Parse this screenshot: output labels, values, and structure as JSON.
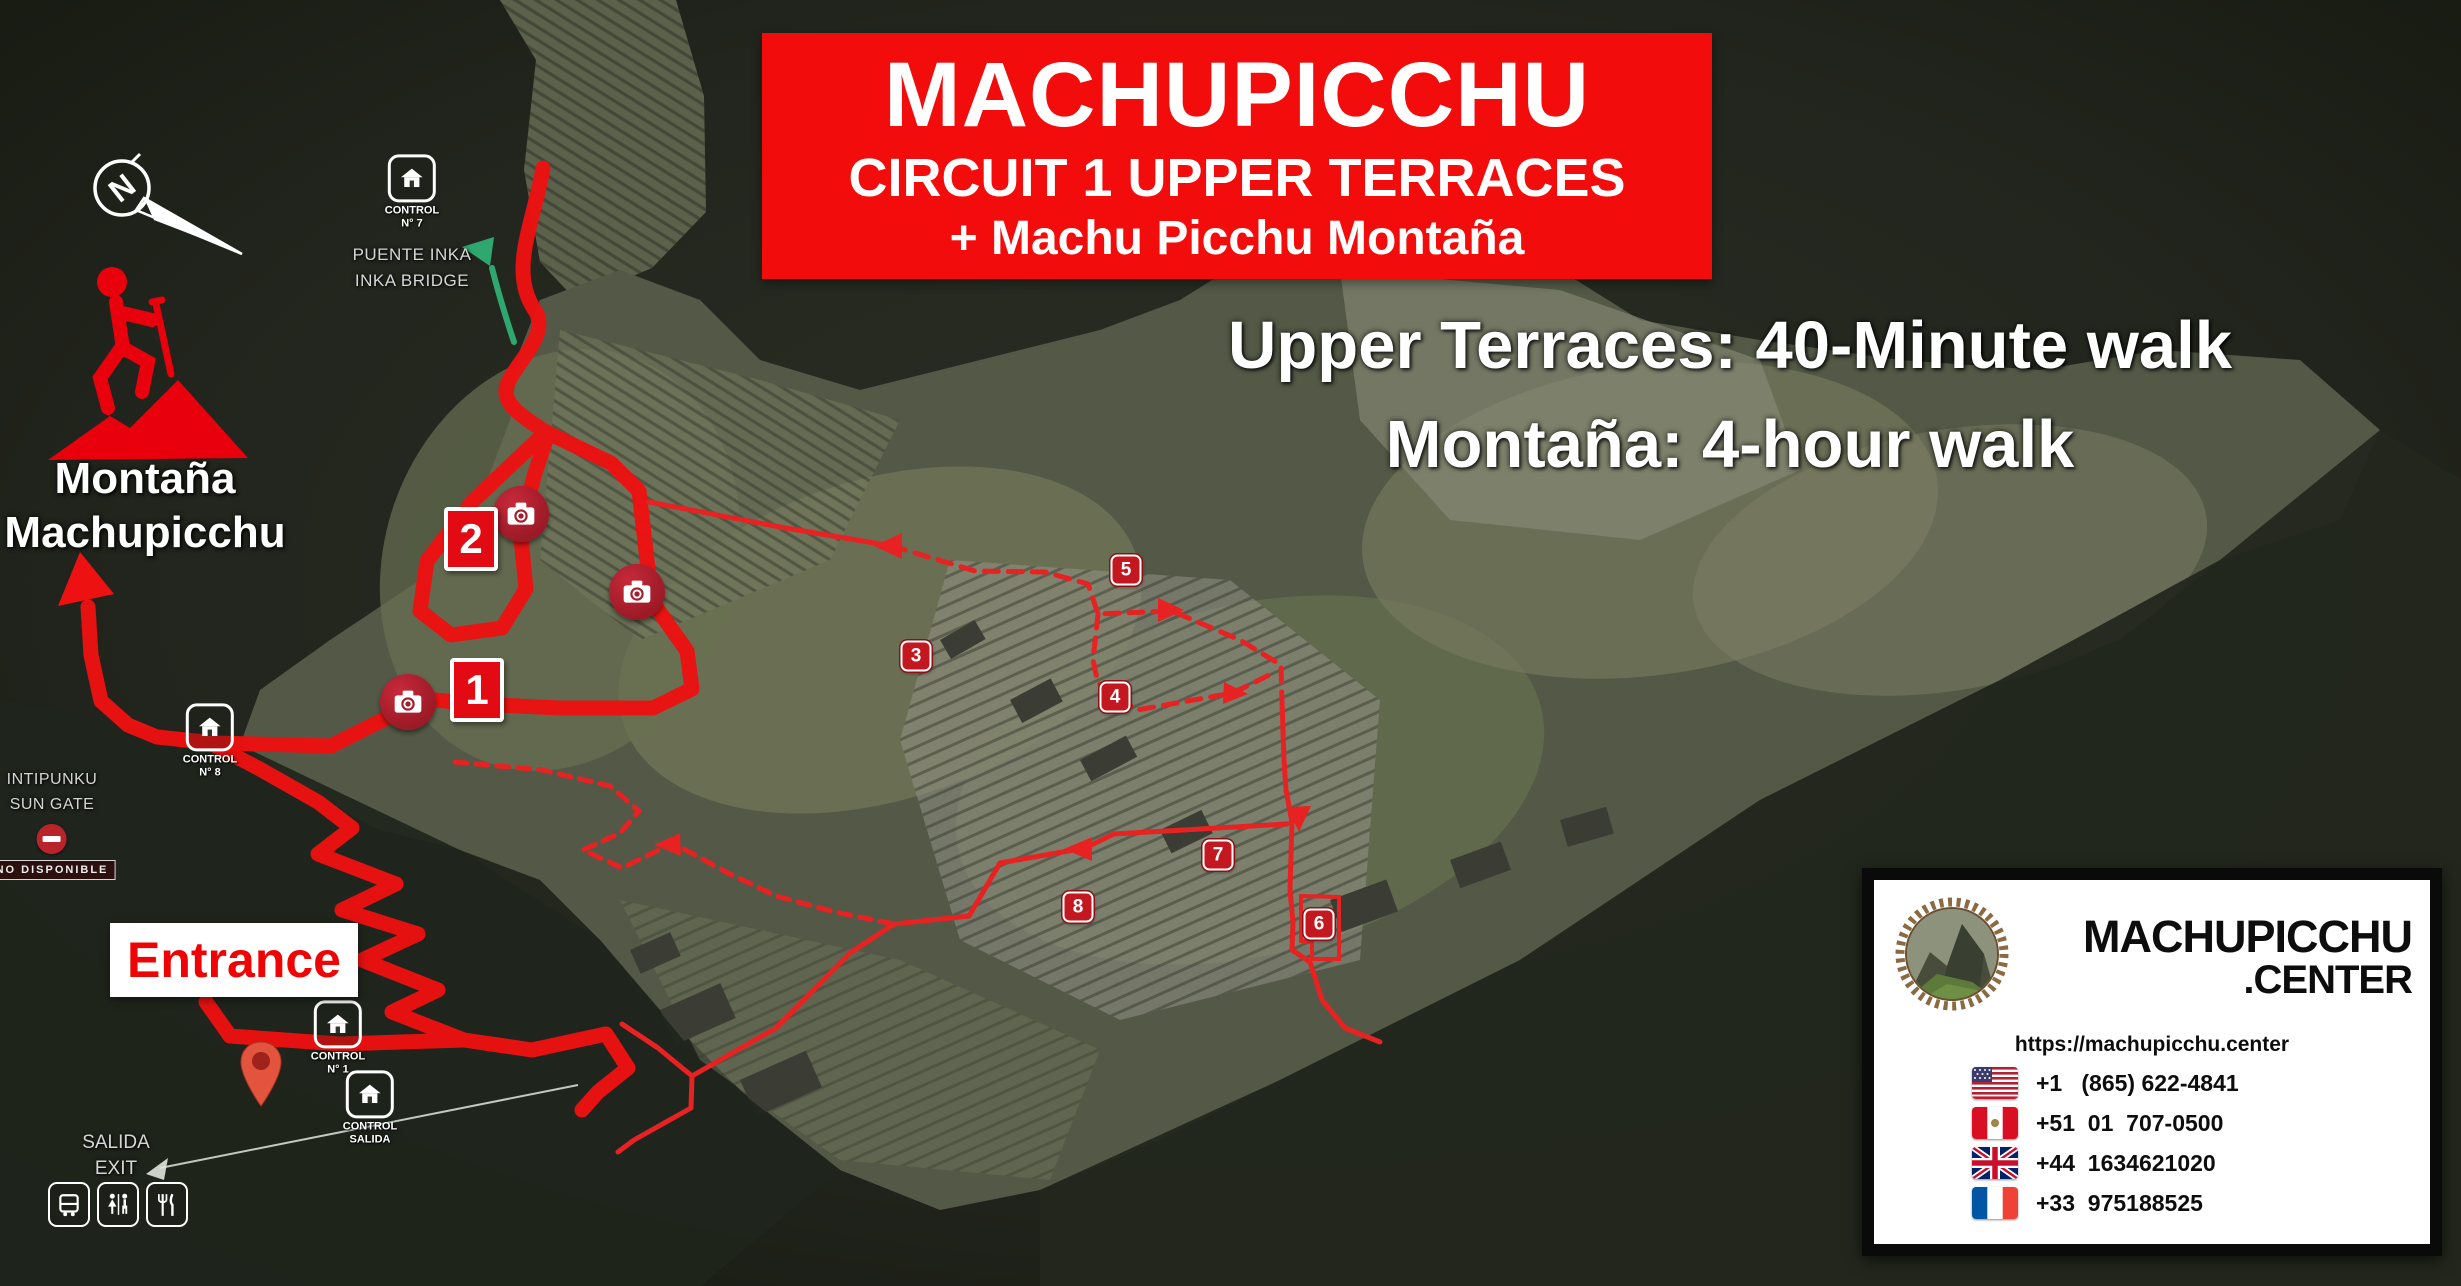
{
  "banner": {
    "title": "MACHUPICCHU",
    "subtitle": "CIRCUIT 1 UPPER TERRACES",
    "tagline": "+ Machu Picchu Montaña"
  },
  "walk_info": {
    "line1": "Upper Terraces: 40-Minute walk",
    "line2": "Montaña: 4-hour walk"
  },
  "montana": {
    "line1": "Montaña",
    "line2": "Machupicchu"
  },
  "compass": {
    "letter": "N"
  },
  "puente_inka": {
    "control": "CONTROL",
    "number": "N° 7",
    "name_es": "PUENTE INKA",
    "name_en": "INKA BRIDGE"
  },
  "intipunku": {
    "name_es": "INTIPUNKU",
    "name_en": "SUN GATE",
    "status": "NO DISPONIBLE"
  },
  "entrance": {
    "label": "Entrance"
  },
  "control_n1": {
    "control": "CONTROL",
    "number": "N° 1"
  },
  "control_n8": {
    "control": "CONTROL",
    "number": "N° 8"
  },
  "control_salida": {
    "control": "CONTROL",
    "number": "SALIDA"
  },
  "exit_sign": {
    "line1": "SALIDA",
    "line2": "EXIT"
  },
  "photo_plates": {
    "p1": "1",
    "p2": "2"
  },
  "waypoints": {
    "w3": "3",
    "w4": "4",
    "w5": "5",
    "w6": "6",
    "w7": "7",
    "w8": "8"
  },
  "info_card": {
    "brand_top": "MACHUPICCHU",
    "brand_bottom": ".CENTER",
    "url": "https://machupicchu.center",
    "phones": [
      {
        "flag": "us",
        "number": "+1   (865) 622-4841"
      },
      {
        "flag": "pe",
        "number": "+51  01  707-0500"
      },
      {
        "flag": "gb",
        "number": "+44  1634621020"
      },
      {
        "flag": "fr",
        "number": "+33  975188525"
      }
    ]
  },
  "colors": {
    "route_red": "#ee1111",
    "banner_red": "#f20c0c",
    "badge_red": "#c3181f",
    "trail_green": "#2ea86f"
  }
}
